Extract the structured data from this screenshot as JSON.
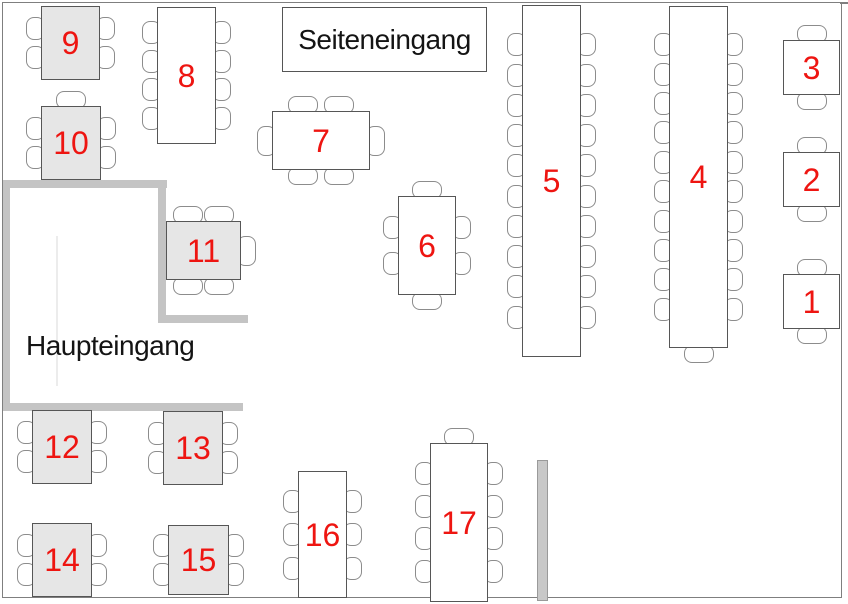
{
  "entrances": {
    "side": {
      "label": "Seiteneingang",
      "box": {
        "x": 282,
        "y": 7,
        "w": 205,
        "h": 65
      }
    },
    "main": {
      "label": "Haupteingang",
      "pos": {
        "x": 26,
        "y": 330
      }
    }
  },
  "colors": {
    "table_number_red": "#ee1511",
    "shaded_table_fill": "#e6e6e6",
    "plain_table_fill": "#ffffff",
    "wall_gray": "#c4c4c4",
    "room_outline_gray": "#7f7f7f",
    "chair_outline_gray": "#8c8c8c"
  },
  "room": {
    "x": 2,
    "y": 2,
    "w": 838,
    "h": 594,
    "top_edge_extension": {
      "x": 840,
      "y": 2,
      "w": 8,
      "h": 2
    }
  },
  "floorplan": {
    "tables": [
      {
        "number": "1",
        "x": 783,
        "y": 274,
        "w": 57,
        "h": 55,
        "shaded": false,
        "chairs": {
          "top": 1,
          "right": 0,
          "bottom": 1,
          "left": 0
        }
      },
      {
        "number": "2",
        "x": 783,
        "y": 152,
        "w": 57,
        "h": 55,
        "shaded": false,
        "chairs": {
          "top": 1,
          "right": 0,
          "bottom": 1,
          "left": 0
        }
      },
      {
        "number": "3",
        "x": 783,
        "y": 40,
        "w": 57,
        "h": 55,
        "shaded": false,
        "chairs": {
          "top": 1,
          "right": 0,
          "bottom": 1,
          "left": 0
        }
      },
      {
        "number": "4",
        "x": 669,
        "y": 6,
        "w": 59,
        "h": 342,
        "shaded": false,
        "chairs": {
          "top": 0,
          "right": 10,
          "bottom": 1,
          "left": 10
        }
      },
      {
        "number": "5",
        "x": 522,
        "y": 5,
        "w": 59,
        "h": 352,
        "shaded": false,
        "chairs": {
          "top": 0,
          "right": 10,
          "bottom": 0,
          "left": 10
        }
      },
      {
        "number": "6",
        "x": 398,
        "y": 196,
        "w": 58,
        "h": 99,
        "shaded": false,
        "chairs": {
          "top": 1,
          "right": 2,
          "bottom": 1,
          "left": 2
        }
      },
      {
        "number": "7",
        "x": 272,
        "y": 111,
        "w": 98,
        "h": 59,
        "shaded": false,
        "chairs": {
          "top": 2,
          "right": 1,
          "bottom": 2,
          "left": 1
        }
      },
      {
        "number": "8",
        "x": 157,
        "y": 7,
        "w": 59,
        "h": 137,
        "shaded": false,
        "chairs": {
          "top": 0,
          "right": 4,
          "bottom": 0,
          "left": 4
        }
      },
      {
        "number": "9",
        "x": 41,
        "y": 6,
        "w": 59,
        "h": 74,
        "shaded": true,
        "chairs": {
          "top": 0,
          "right": 2,
          "bottom": 0,
          "left": 2
        }
      },
      {
        "number": "10",
        "x": 41,
        "y": 106,
        "w": 60,
        "h": 74,
        "shaded": true,
        "chairs": {
          "top": 1,
          "right": 2,
          "bottom": 0,
          "left": 2
        }
      },
      {
        "number": "11",
        "x": 166,
        "y": 221,
        "w": 75,
        "h": 59,
        "shaded": true,
        "chairs": {
          "top": 2,
          "right": 1,
          "bottom": 2,
          "left": 0
        }
      },
      {
        "number": "12",
        "x": 32,
        "y": 410,
        "w": 60,
        "h": 74,
        "shaded": true,
        "chairs": {
          "top": 0,
          "right": 2,
          "bottom": 0,
          "left": 2
        }
      },
      {
        "number": "13",
        "x": 163,
        "y": 411,
        "w": 60,
        "h": 74,
        "shaded": true,
        "chairs": {
          "top": 0,
          "right": 2,
          "bottom": 0,
          "left": 2
        }
      },
      {
        "number": "14",
        "x": 32,
        "y": 523,
        "w": 60,
        "h": 74,
        "shaded": true,
        "chairs": {
          "top": 0,
          "right": 2,
          "bottom": 0,
          "left": 2
        }
      },
      {
        "number": "15",
        "x": 168,
        "y": 525,
        "w": 61,
        "h": 70,
        "shaded": true,
        "chairs": {
          "top": 0,
          "right": 2,
          "bottom": 0,
          "left": 2
        }
      },
      {
        "number": "16",
        "x": 298,
        "y": 471,
        "w": 49,
        "h": 127,
        "shaded": false,
        "chairs": {
          "top": 0,
          "right": 3,
          "bottom": 0,
          "left": 3
        }
      },
      {
        "number": "17",
        "x": 430,
        "y": 443,
        "w": 58,
        "h": 159,
        "shaded": false,
        "chairs": {
          "top": 1,
          "right": 4,
          "bottom": 0,
          "left": 4
        }
      }
    ],
    "walls": [
      {
        "name": "vestibule-wall-top",
        "x": 3,
        "y": 180,
        "w": 164,
        "h": 8
      },
      {
        "name": "vestibule-wall-left",
        "x": 3,
        "y": 180,
        "w": 7,
        "h": 230
      },
      {
        "name": "vestibule-wall-bottom",
        "x": 3,
        "y": 403,
        "w": 240,
        "h": 8
      },
      {
        "name": "vestibule-wall-inner-vertical",
        "x": 158,
        "y": 180,
        "w": 8,
        "h": 142
      },
      {
        "name": "vestibule-wall-inner-horizontal",
        "x": 158,
        "y": 315,
        "w": 90,
        "h": 8
      }
    ],
    "divider_screen": {
      "x": 537,
      "y": 460,
      "w": 11,
      "h": 141
    },
    "door_line": {
      "x": 56,
      "y": 236,
      "w": 2,
      "h": 150
    }
  }
}
